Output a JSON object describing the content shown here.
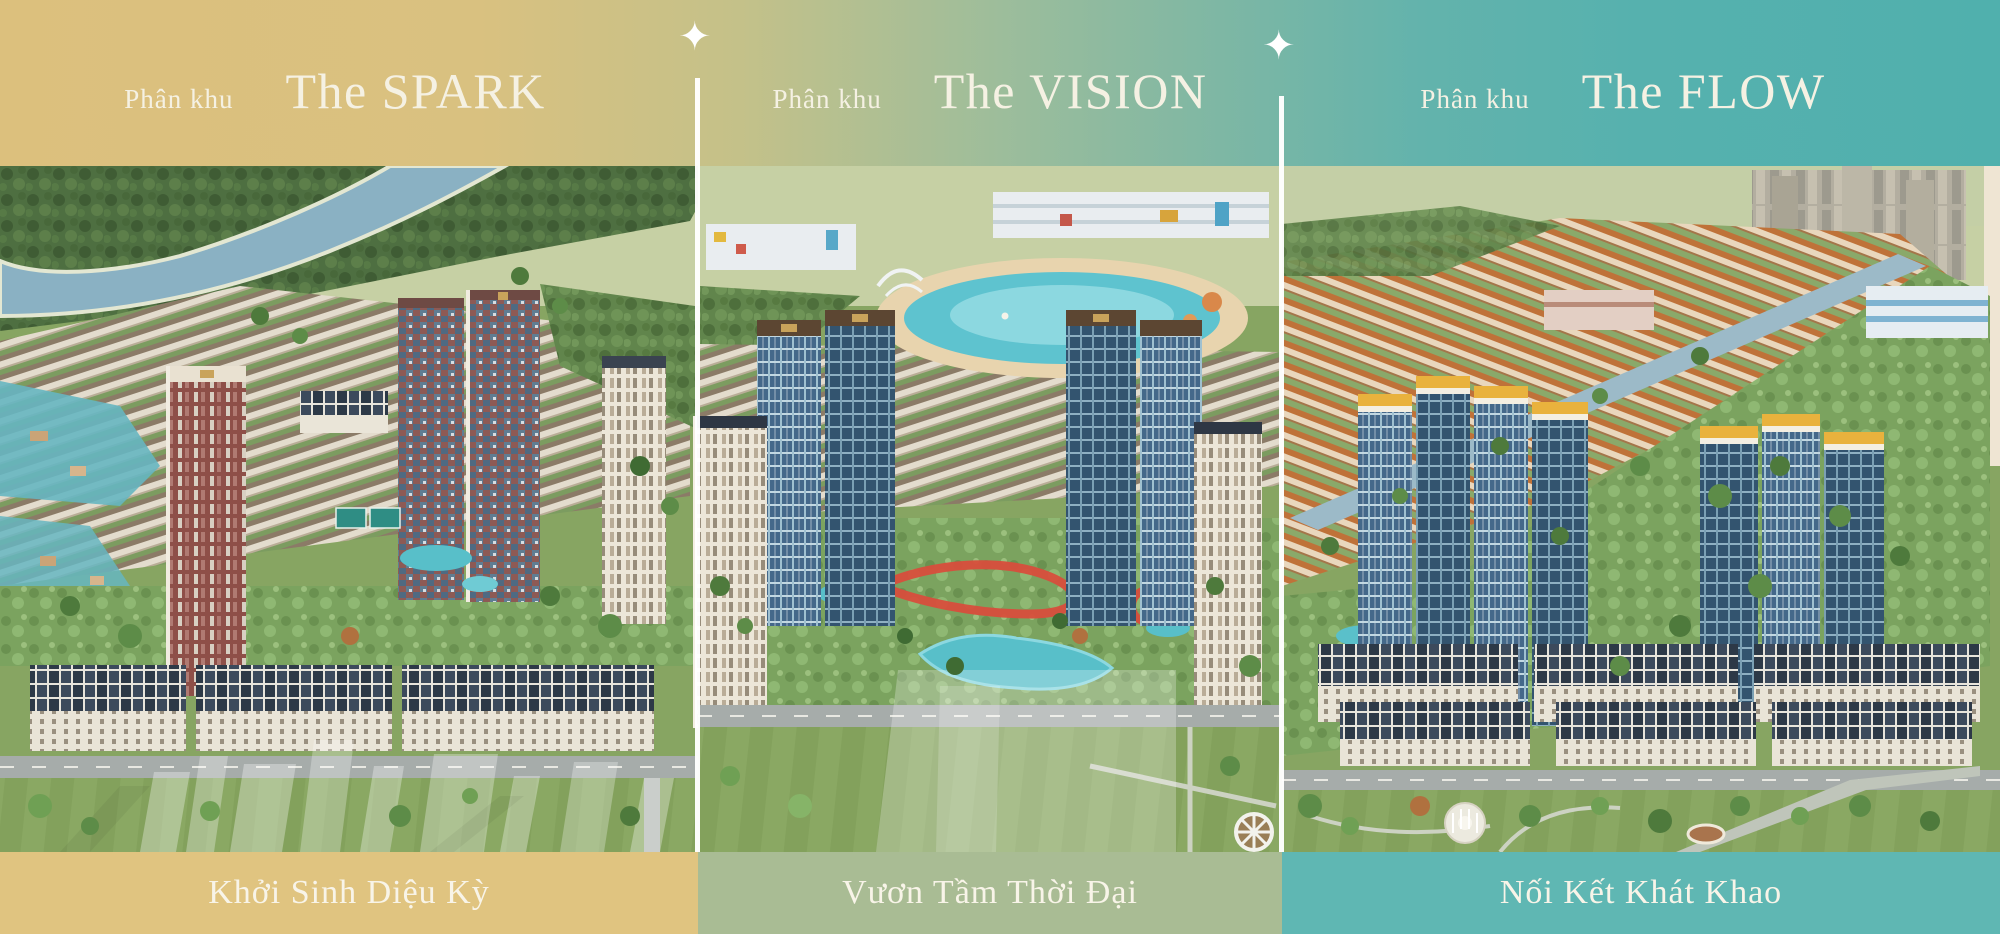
{
  "banner": {
    "language": "vi",
    "sparkle_glyph": "✦",
    "divider_color": "#FFFFFF",
    "text_color": "#F5F1E3",
    "sections": [
      {
        "kicker": "Phân khu",
        "title": "The SPARK",
        "slogan": "Khởi Sinh Diệu Kỳ",
        "header_color": "#DCC07D",
        "bar_color": "#E0C480"
      },
      {
        "kicker": "Phân khu",
        "title": "The VISION",
        "slogan": "Vươn Tầm Thời Đại",
        "header_color": "#9DBD9B",
        "bar_color": "#A9BC94"
      },
      {
        "kicker": "Phân khu",
        "title": "The FLOW",
        "slogan": "Nối Kết Khát Khao",
        "header_color": "#55B1AE",
        "bar_color": "#5FB7B3"
      }
    ]
  }
}
